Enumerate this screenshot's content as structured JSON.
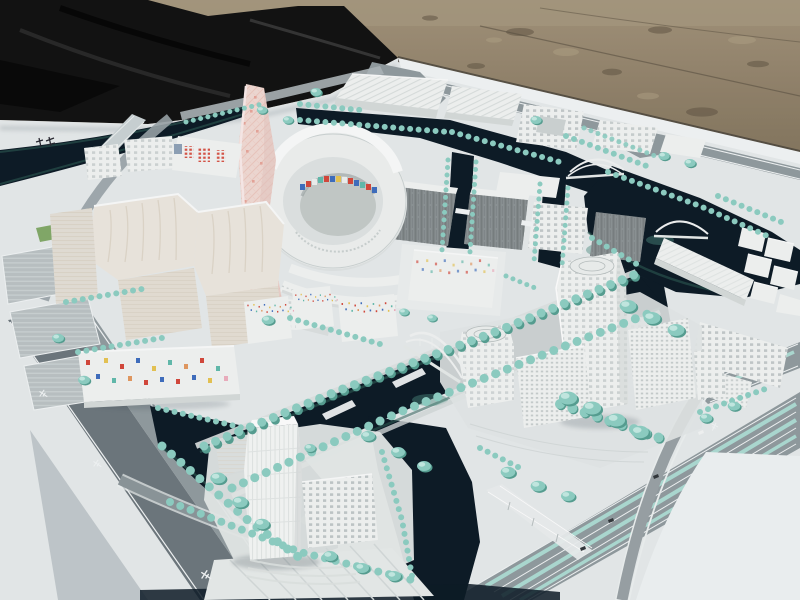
{
  "scene": {
    "ground_label": "gravel-ground",
    "tarp_label": "black-tarp",
    "board_label": "white-model-base-board",
    "model_label": "waterfront-district-scale-model",
    "landmarks": [
      "pink-patterned-tower",
      "circular-courtyard-complex",
      "confetti-facade-housing",
      "twin-office-towers",
      "riverside-tower",
      "arch-footbridges",
      "canal-network",
      "tree-lined-boulevard"
    ]
  },
  "annotations": {
    "board_mark_legible": false,
    "road_marks_legible": false
  },
  "palette": {
    "gravel": "#8a7b64",
    "gravelLight": "#a2937a",
    "gravelDark": "#675a48",
    "tarp": "#121212",
    "board": "#e8eced",
    "boardBright": "#f3f6f7",
    "boardShadow": "#c2cacd",
    "water": "#0d1b27",
    "waterShallow": "#2f5f58",
    "algae": "#4d8d80",
    "tree": "#8fd0c5",
    "treeLight": "#c6ece5",
    "treeDark": "#57a093",
    "road": "#929ca0",
    "roadDark": "#6e787e",
    "roadLight": "#aeb7ba",
    "bldgWhite": "#f3f5f4",
    "bldgShade": "#d7dcdb",
    "bldgRoof": "#fbfcfc",
    "bldgEdge": "#b9c1c1",
    "grayFacade": "#8d9496",
    "grayDark": "#6f7678",
    "cream": "#eee9e1",
    "creamShade": "#e7e1d6",
    "pink": "#f2dbd5",
    "pinkDeep": "#e9a79b",
    "accentRed": "#d6493c",
    "accentBlue": "#3f6fc0",
    "accentYellow": "#e9c654",
    "accentTeal": "#63bcae",
    "accentOrange": "#e59a62",
    "accentPink": "#efb0c0",
    "lawn": "#7ba55e"
  }
}
